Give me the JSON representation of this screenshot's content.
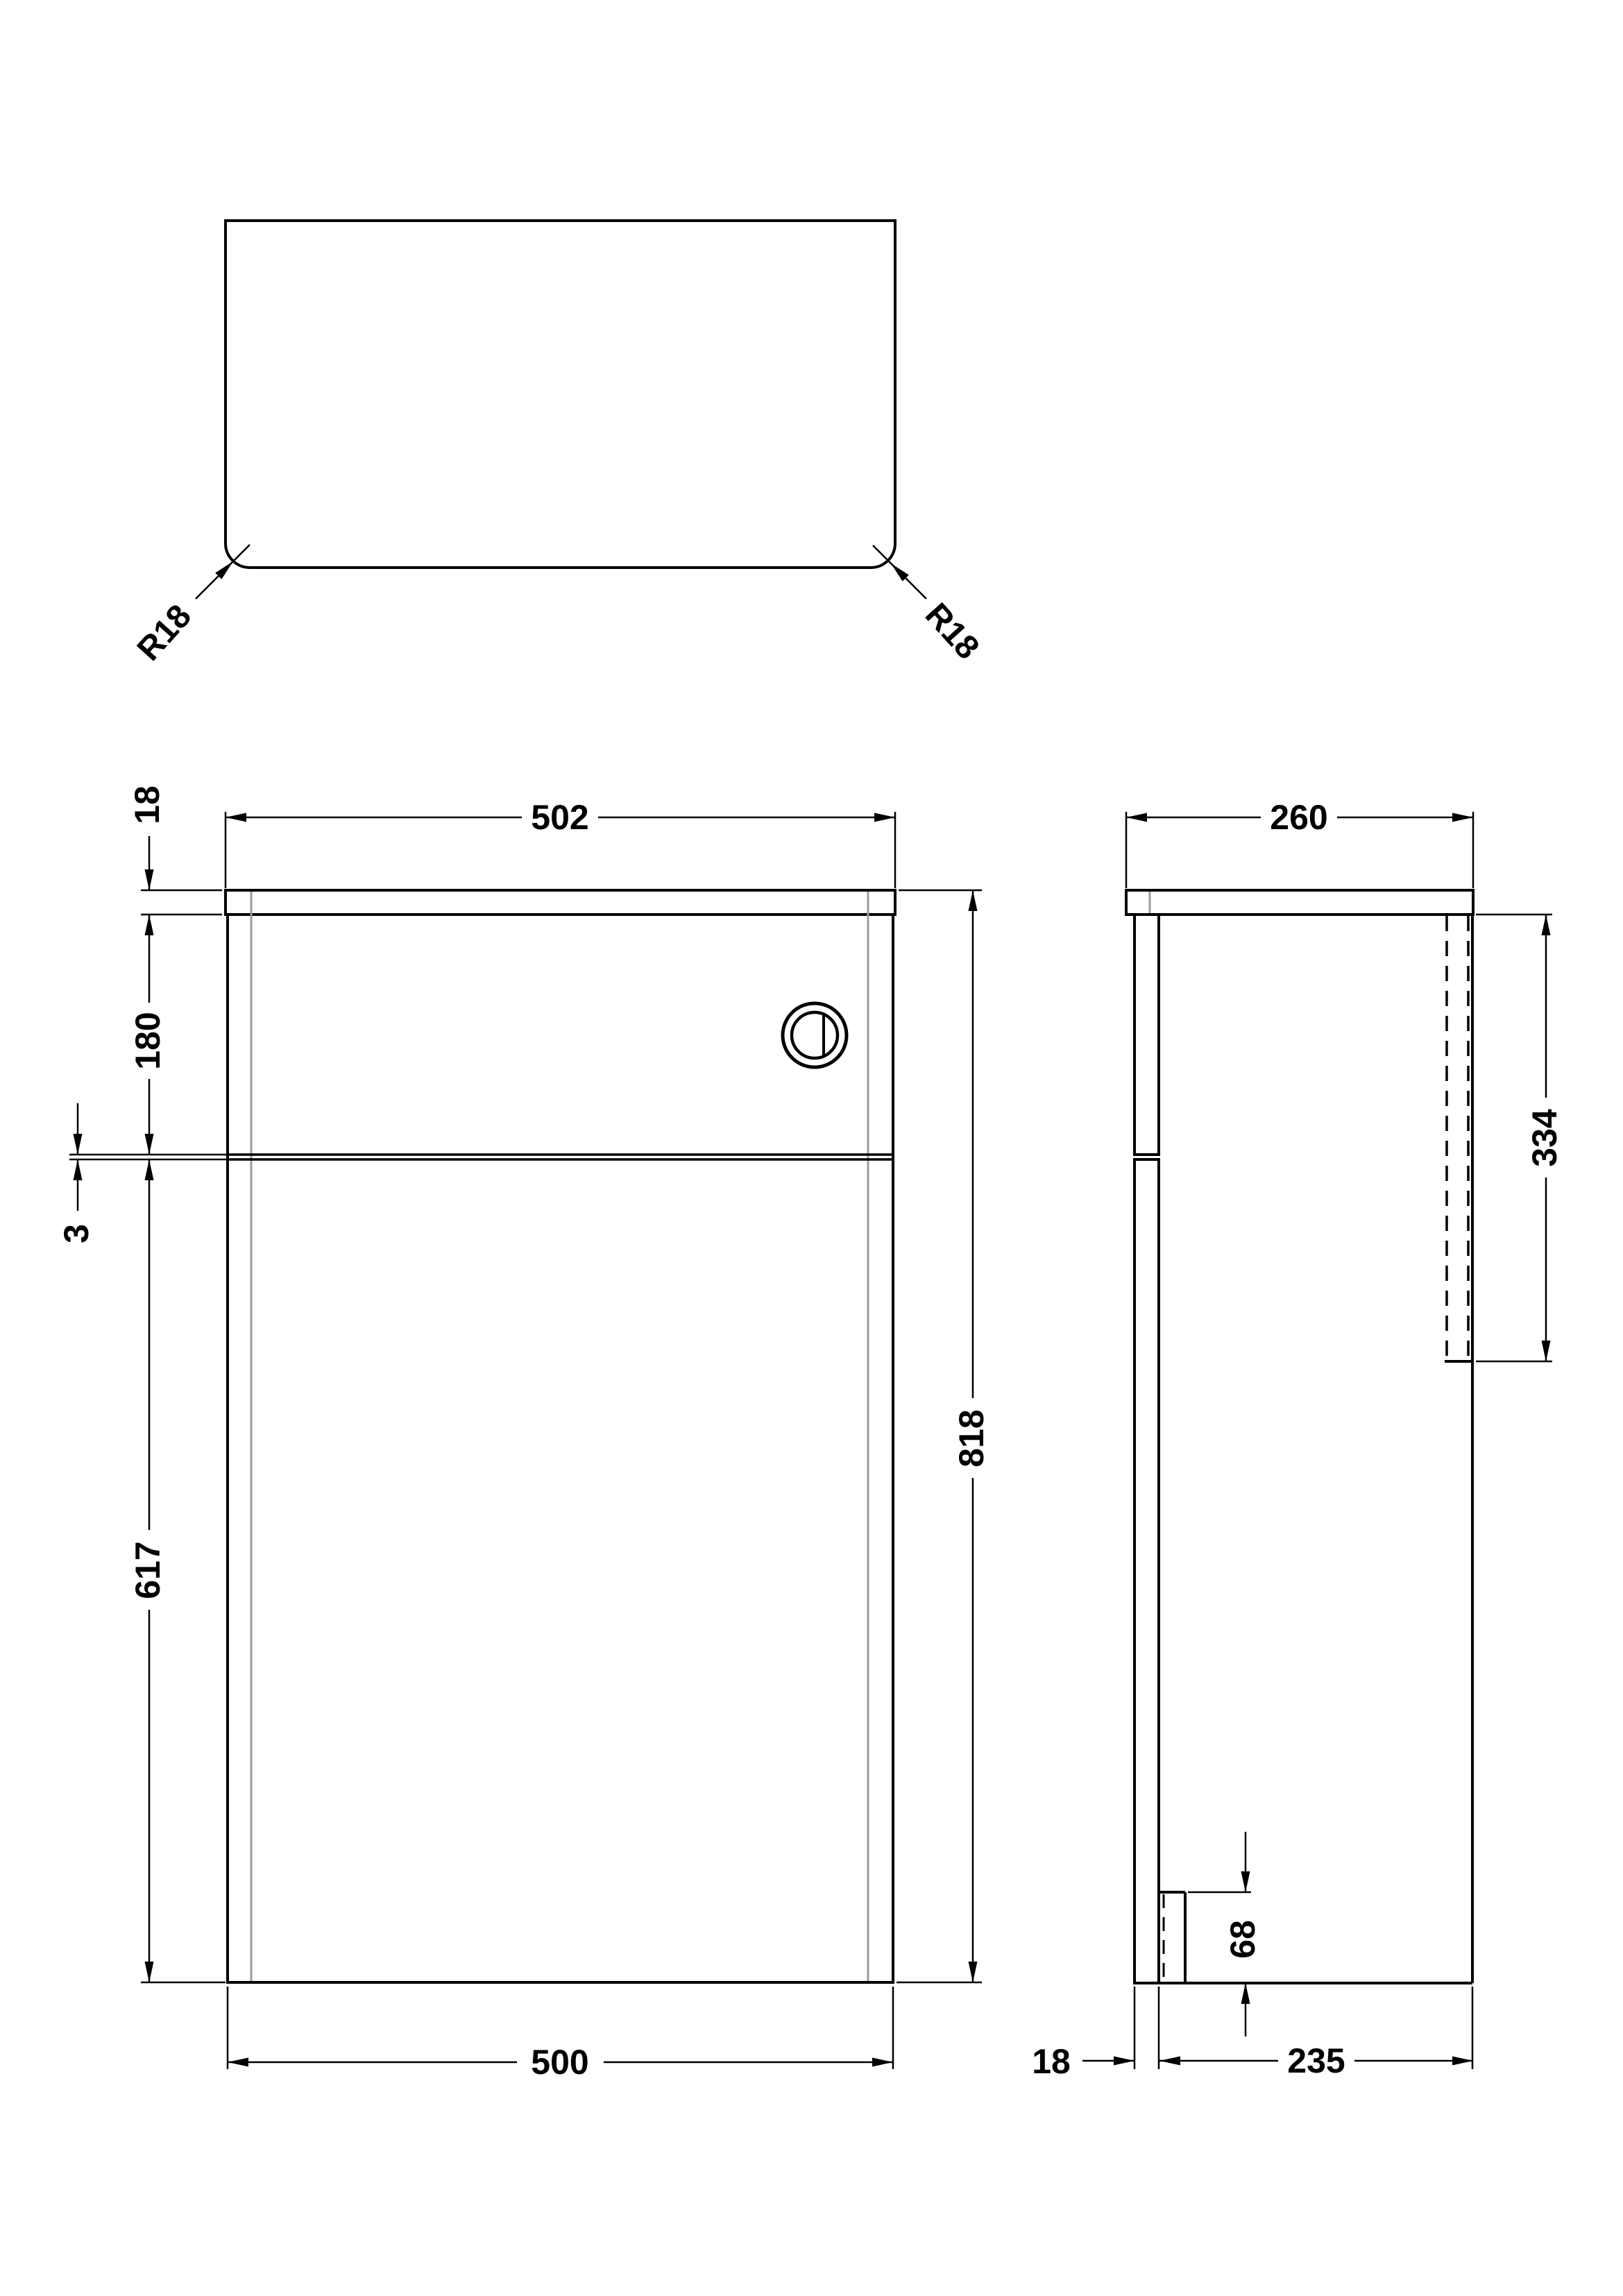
{
  "colors": {
    "line_black": "#000000",
    "panel_gray": "#9c9c9c",
    "background": "#ffffff"
  },
  "top_view": {
    "radius_left": "R18",
    "radius_right": "R18"
  },
  "front_view": {
    "worktop_thickness": "18",
    "overall_width": "502",
    "cistern_panel_height": "180",
    "panel_gap": "3",
    "door_height": "617",
    "overall_height": "818",
    "cabinet_width": "500"
  },
  "side_view": {
    "overall_depth": "260",
    "back_panel_height": "334",
    "plinth_recess_height": "68",
    "front_panel_thickness": "18",
    "cabinet_depth": "235"
  }
}
